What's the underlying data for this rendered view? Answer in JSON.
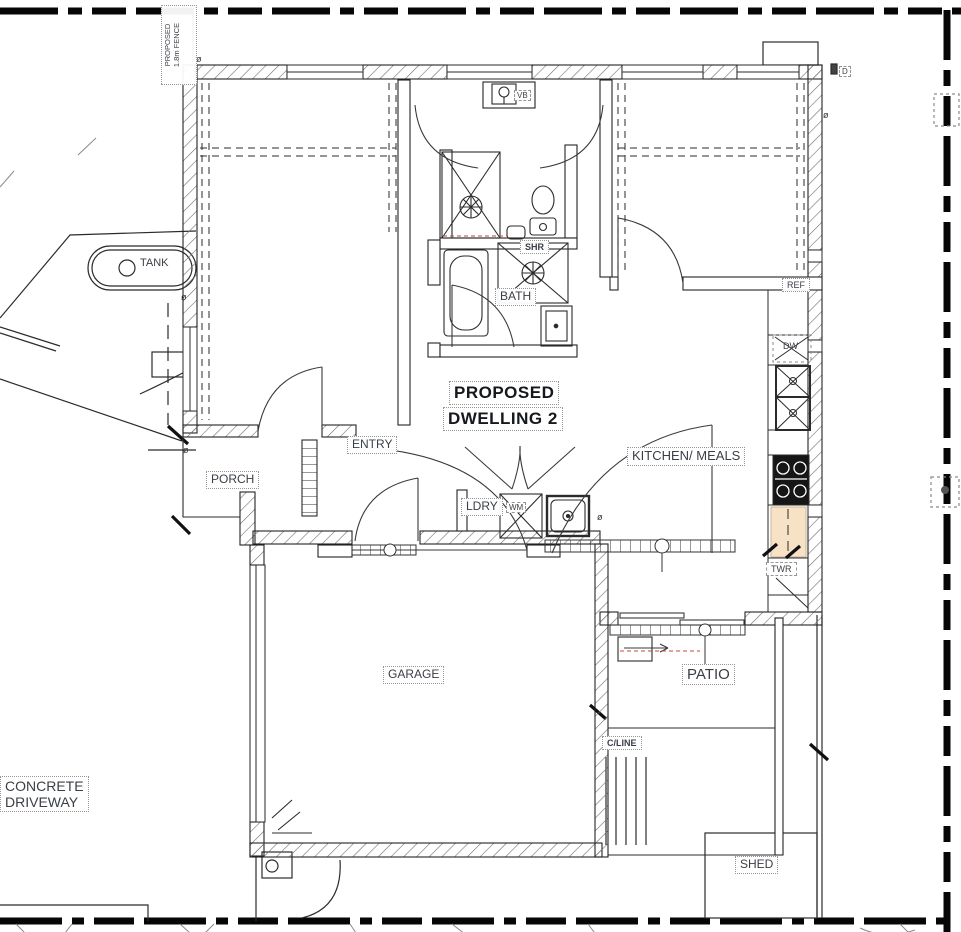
{
  "title": {
    "line1": "PROPOSED",
    "line2": "DWELLING 2"
  },
  "site": {
    "fence_line1": "PROPOSED",
    "fence_line2": "1.8m FENCE",
    "tank": "TANK",
    "driveway_line1": "CONCRETE",
    "driveway_line2": "DRIVEWAY",
    "clothesline": "C/LINE",
    "shed": "SHED",
    "door_mark": "D",
    "diameter_mark": "ø"
  },
  "rooms": {
    "entry": "ENTRY",
    "porch": "PORCH",
    "bath": "BATH",
    "kitchen_meals": "KITCHEN/ MEALS",
    "laundry": "LDRY",
    "garage": "GARAGE",
    "patio": "PATIO"
  },
  "fixtures": {
    "vanity_basin": "VB",
    "shower": "SHR",
    "washing_machine": "WM",
    "refrigerator": "REF",
    "dishwasher": "DW",
    "tower": "TWR"
  },
  "colors": {
    "boundary": "#060606",
    "wall_line": "#232323",
    "bench_fill": "#f7e2c6",
    "label_text": "#3a3f46"
  }
}
